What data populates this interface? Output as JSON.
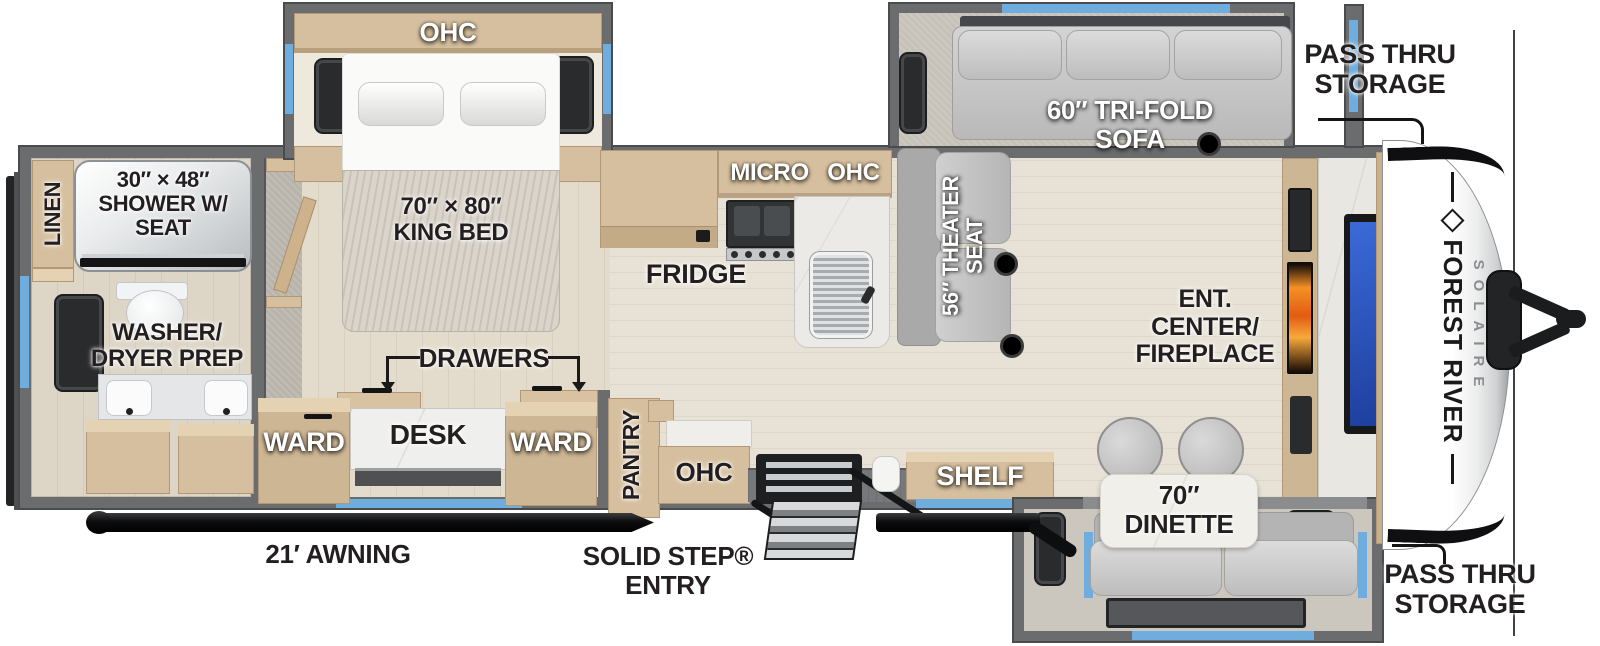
{
  "colors": {
    "window_blue": "#6fadde",
    "wall_gray": "#6a6c6e",
    "cabinet_tan": "#d5bf9e",
    "floor_beige": "#e8e2d6",
    "fireplace_orange": "#f1811f",
    "tv_screen_blue": "#2d57c8",
    "awning_black": "#111214",
    "label_dark": "#231f20"
  },
  "labels": {
    "bedroom_ohc": "OHC",
    "king_bed": {
      "line1": "70″ × 80″",
      "line2": "KING BED"
    },
    "linen": "LINEN",
    "shower": {
      "line1": "30″ × 48″",
      "line2": "SHOWER W/",
      "line3": "SEAT"
    },
    "washer_dryer": {
      "line1": "WASHER/",
      "line2": "DRYER PREP"
    },
    "drawers": "DRAWERS",
    "ward_left": "WARD",
    "desk": "DESK",
    "ward_right": "WARD",
    "pantry": "PANTRY",
    "entry_ohc": "OHC",
    "micro_ohc": "MICRO OHC",
    "fridge": "FRIDGE",
    "theater_seat": {
      "line1": "56″ THEATER",
      "line2": "SEAT"
    },
    "trifold_sofa": {
      "line1": "60″ TRI-FOLD",
      "line2": "SOFA"
    },
    "pass_thru_top": {
      "line1": "PASS THRU",
      "line2": "STORAGE"
    },
    "pass_thru_bottom": {
      "line1": "PASS THRU",
      "line2": "STORAGE"
    },
    "ent_center": {
      "line1": "ENT.",
      "line2": "CENTER/",
      "line3": "FIREPLACE"
    },
    "shelf": "SHELF",
    "dinette": {
      "line1": "70″",
      "line2": "DINETTE"
    },
    "awning": "21′ AWNING",
    "solid_step": {
      "line1": "SOLID STEP®",
      "line2": "ENTRY"
    },
    "brand": {
      "name": "FOREST RIVER",
      "model": "SOLAIRE"
    }
  }
}
